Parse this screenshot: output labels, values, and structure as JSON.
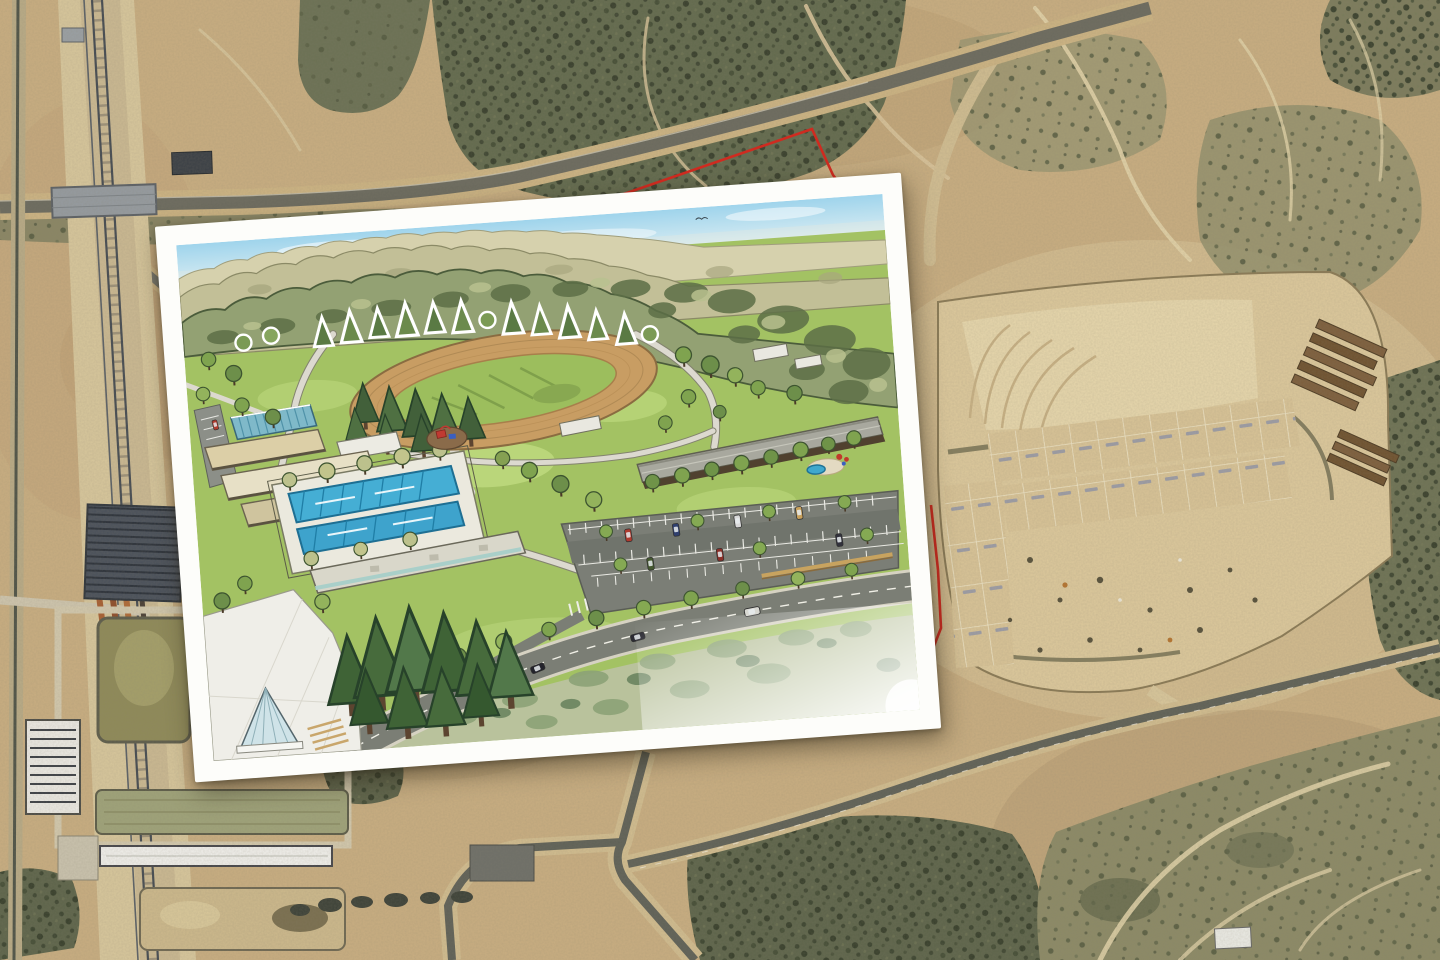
{
  "meta": {
    "kind": "composite-aerial-photo-with-rendering-inset",
    "width_px": 1440,
    "height_px": 960,
    "visible_text": "none (tiny illegible lot labels only)"
  },
  "palette": {
    "sand_base": "#c9ae81",
    "sand_light": "#dcc89c",
    "sand_pale": "#e7d7ac",
    "scrub_dark": "#5d644a",
    "road_asphalt": "#6b6a5e",
    "road_shoulder": "#cdb483",
    "boundary_red": "#cf2b20",
    "rail_dark": "#454b52",
    "solar_panel": "#49505a",
    "pond_olive": "#8f8a58",
    "pond_tan": "#c2ae7e",
    "building_white": "#eceae4",
    "sky_top": "#9fd4ec",
    "sky_bottom": "#eef3e9",
    "ridge_far": "#c2bf97",
    "ridge_near": "#93a173",
    "lawn": "#a3c263",
    "lawn_light": "#c2dc82",
    "track_tan": "#c89d63",
    "infield": "#9cbe5d",
    "pool_blue": "#45aed4",
    "pool_blue2": "#3ea3cc",
    "deck_white": "#ebe9de",
    "roof_gray": "#a8a89e",
    "roof_tan": "#dccfa7",
    "glass_blue": "#7fb9c9",
    "parking_gray": "#7b7e76",
    "render_road": "#7b7e75",
    "conifer_dark": "#3f6336",
    "canopy_green": "#7fa34f",
    "sage_tree": "#bcc18c",
    "shade_brown": "#50412f",
    "play_red": "#c03a32",
    "play_blue": "#3b5fc0",
    "wall_tan": "#c8a35f",
    "scrub_sage": "#b9c29c",
    "inset_frame": "#fdfdfa"
  },
  "aerial": {
    "features": [
      "railroad-corridor",
      "overpass-bridge",
      "water-facility",
      "solar-arrays",
      "settling-ponds",
      "station-building",
      "platform-building",
      "train-cars",
      "main-road",
      "scrub-vegetation",
      "construction-site",
      "graded-pads",
      "lot-grid",
      "timber-stacks",
      "dirt-trails",
      "road-intersection",
      "red-parcel-boundary"
    ]
  },
  "inset": {
    "type": "architectural-park-rendering",
    "rotation_deg": -4.15,
    "frame_border_px": 20,
    "features": [
      "sky",
      "birds",
      "distant-ridge",
      "forest-hills",
      "berm-tree-row",
      "running-track",
      "infield",
      "swimming-pools",
      "pool-deck",
      "terrace-buildings",
      "glass-building",
      "playground",
      "recreation-building",
      "service-huts",
      "parking-lot",
      "access-road",
      "crosswalks",
      "conifer-grove",
      "entry-plaza",
      "glass-pavilion",
      "street-trees",
      "roadside-scrub",
      "cars"
    ]
  }
}
